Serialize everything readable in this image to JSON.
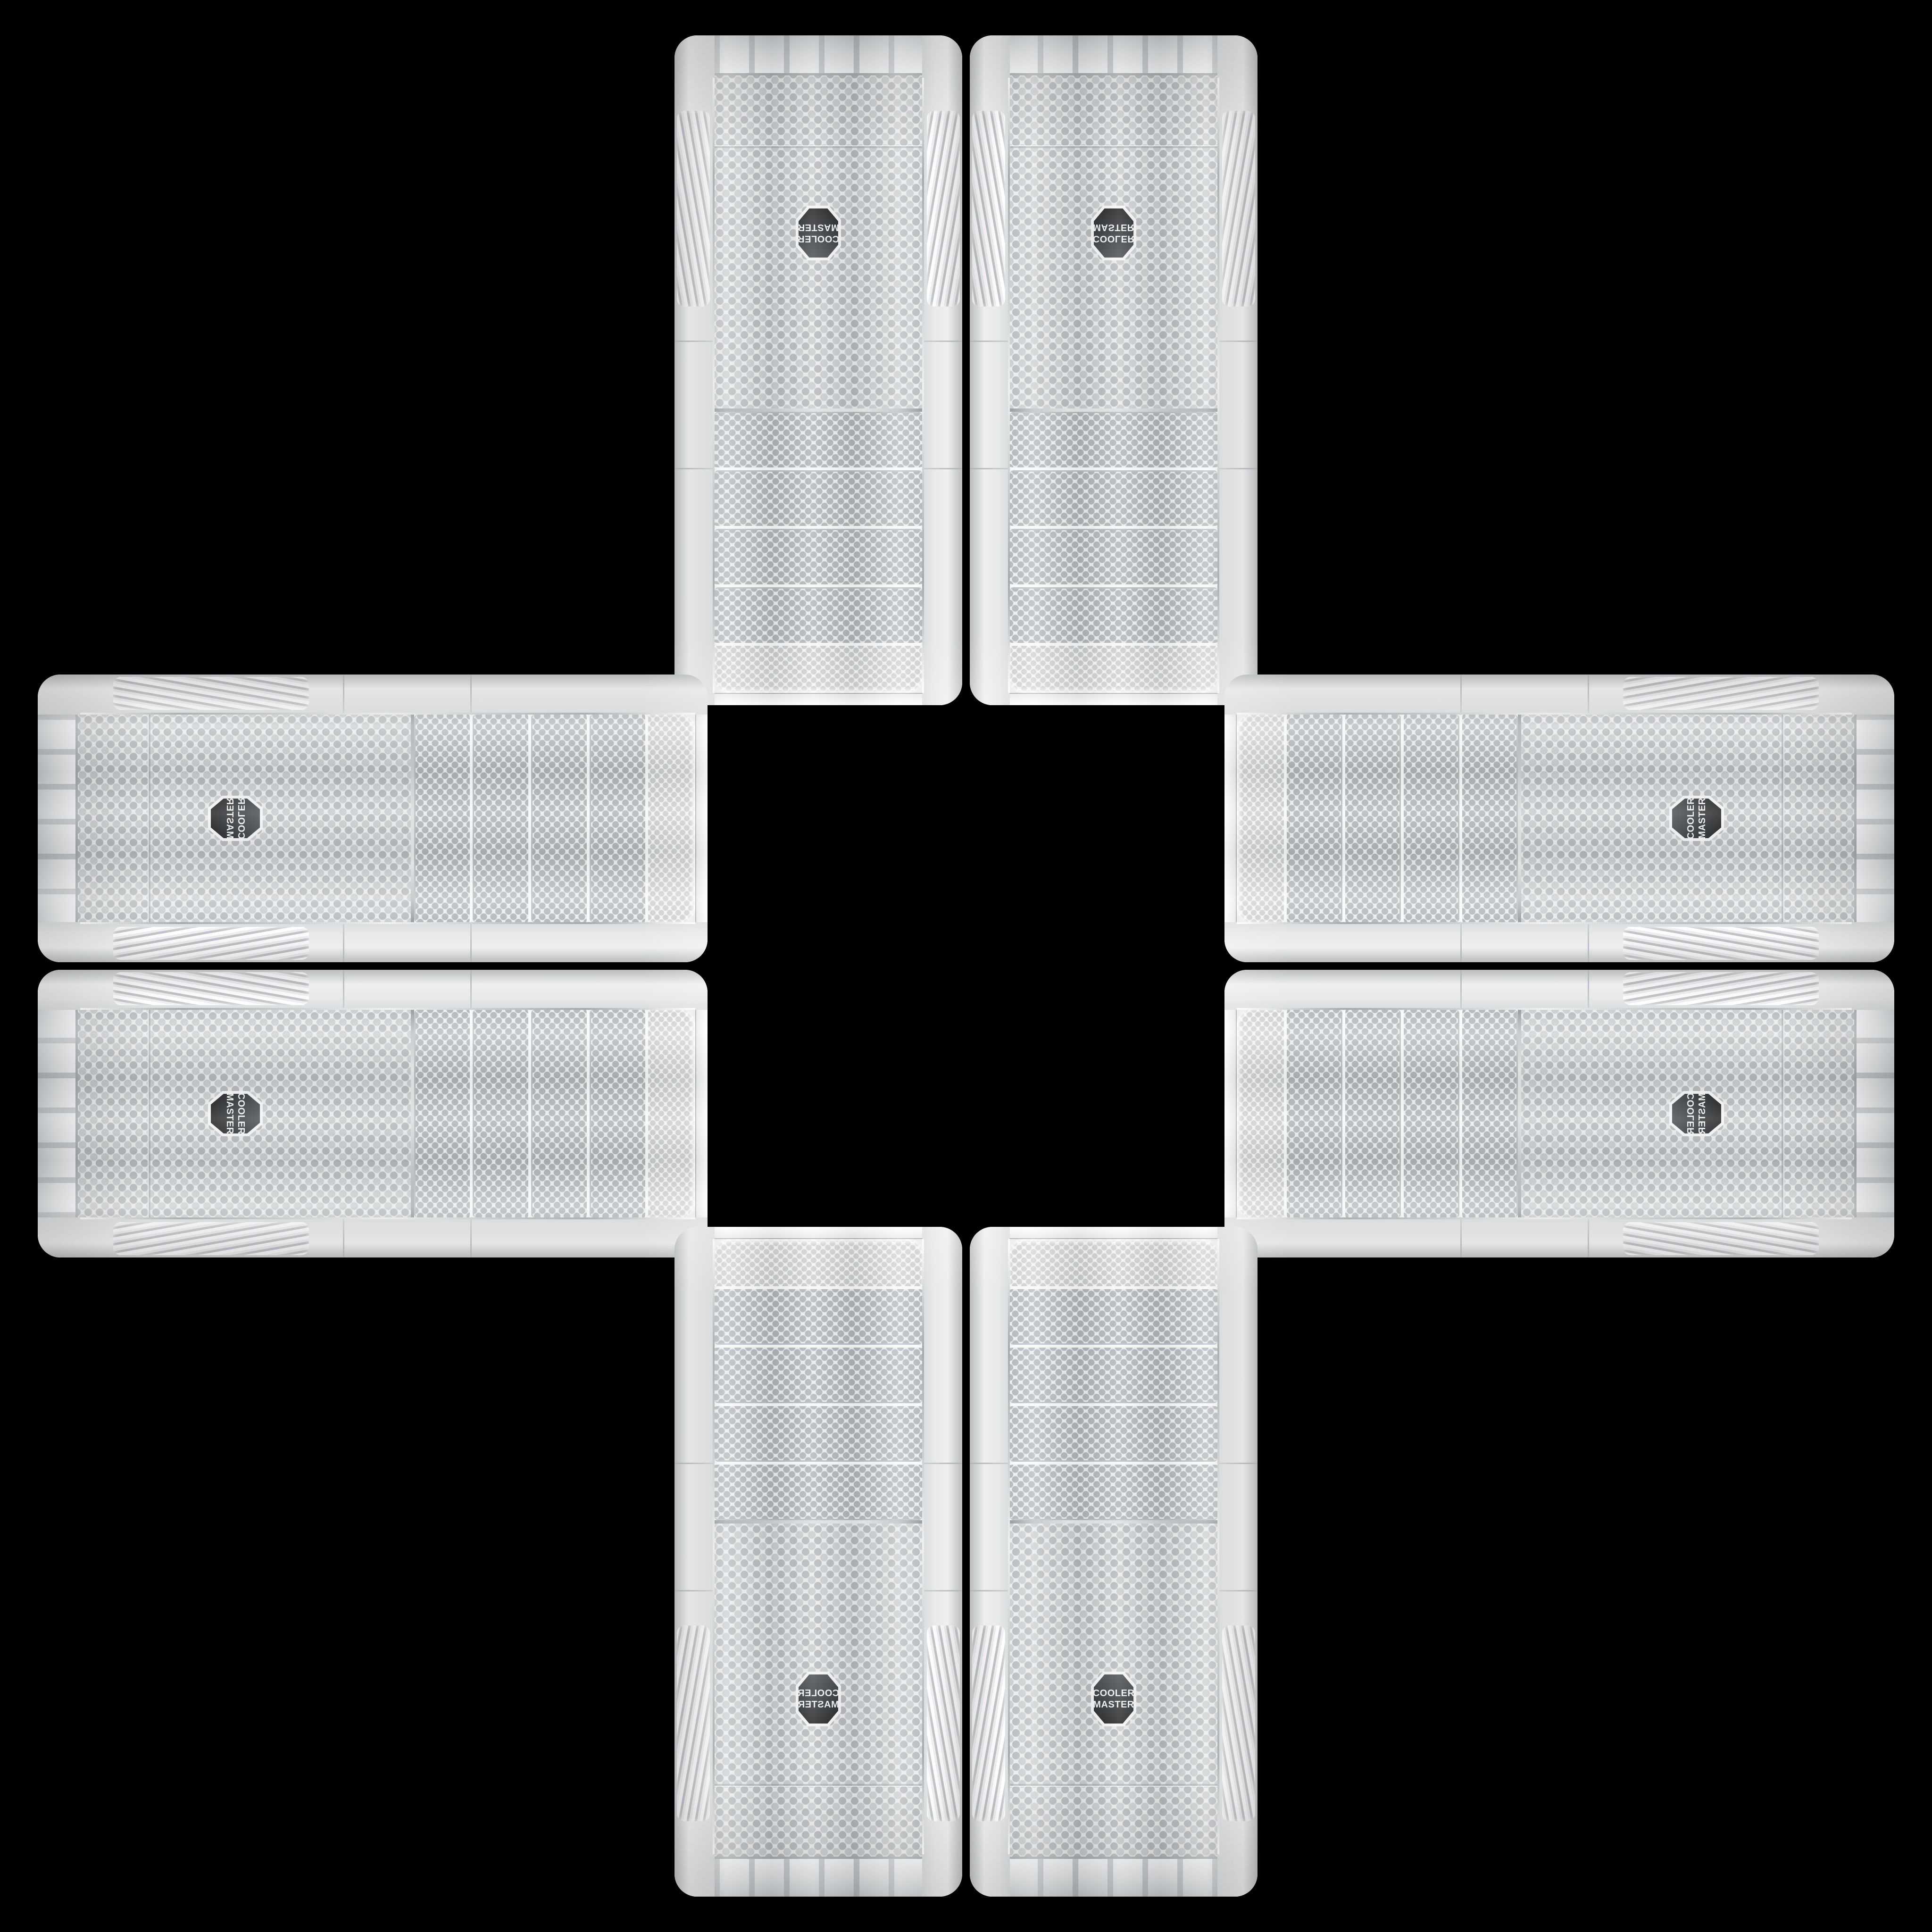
{
  "background_color": "#000000",
  "brand": {
    "line1": "COOLER",
    "line2": "MASTER"
  },
  "badge": {
    "shape": "hexagon",
    "name": "cooler-master-logo-badge"
  },
  "palette": {
    "bg": "#000000",
    "body": "#f0f1f2",
    "body_hi": "#fbfcfc",
    "body_lo": "#cfd3d5",
    "vent_base": "#f2f3f4",
    "vent_dot": "#c6c9cb",
    "strip_base": "#eaecee",
    "strip_dot": "#aeb3b6",
    "mesh_base": "#e9eaeb",
    "mesh_dot": "#b3b7ba",
    "chrome": "#9aa1a5",
    "groove": "#c6cacc",
    "badge_frame": "#f3f4f5",
    "badge_bg": "#2b2f31",
    "badge_text": "#eef0f1"
  },
  "cases": [
    {
      "id": "case-top-left-vertical",
      "slot": "slot-tl",
      "slot_type": "v",
      "orientation": "o-rot180",
      "appearance": "vertical tower, rotated 180, logo upside down, drive bays at bottom"
    },
    {
      "id": "case-top-right-vertical",
      "slot": "slot-tr",
      "slot_type": "v",
      "orientation": "o-flipy",
      "appearance": "vertical tower, flipped vertically, drive bays at bottom"
    },
    {
      "id": "case-left-top-horizontal",
      "slot": "slot-lt",
      "slot_type": "h",
      "orientation": "o-mirrorccw",
      "appearance": "horizontal tower, mirrored, drive bays at right"
    },
    {
      "id": "case-left-bottom-horizontal",
      "slot": "slot-lb",
      "slot_type": "h",
      "orientation": "o-cw",
      "appearance": "horizontal tower, rotated 90 clockwise, drive bays at right"
    },
    {
      "id": "case-right-top-horizontal",
      "slot": "slot-rt",
      "slot_type": "h",
      "orientation": "o-ccw",
      "appearance": "horizontal tower, rotated 90 counter-clockwise, drive bays at left"
    },
    {
      "id": "case-right-bottom-horizontal",
      "slot": "slot-rb",
      "slot_type": "h",
      "orientation": "o-mirrorcw",
      "appearance": "horizontal tower, mirrored, drive bays at left"
    },
    {
      "id": "case-bottom-left-vertical",
      "slot": "slot-bl",
      "slot_type": "v",
      "orientation": "o-flipx",
      "appearance": "vertical tower, mirrored horizontally, logo text reversed, drive bays at top"
    },
    {
      "id": "case-bottom-right-vertical",
      "slot": "slot-br",
      "slot_type": "v",
      "orientation": "o-none",
      "appearance": "vertical tower, upright, logo readable, drive bays at top"
    }
  ]
}
